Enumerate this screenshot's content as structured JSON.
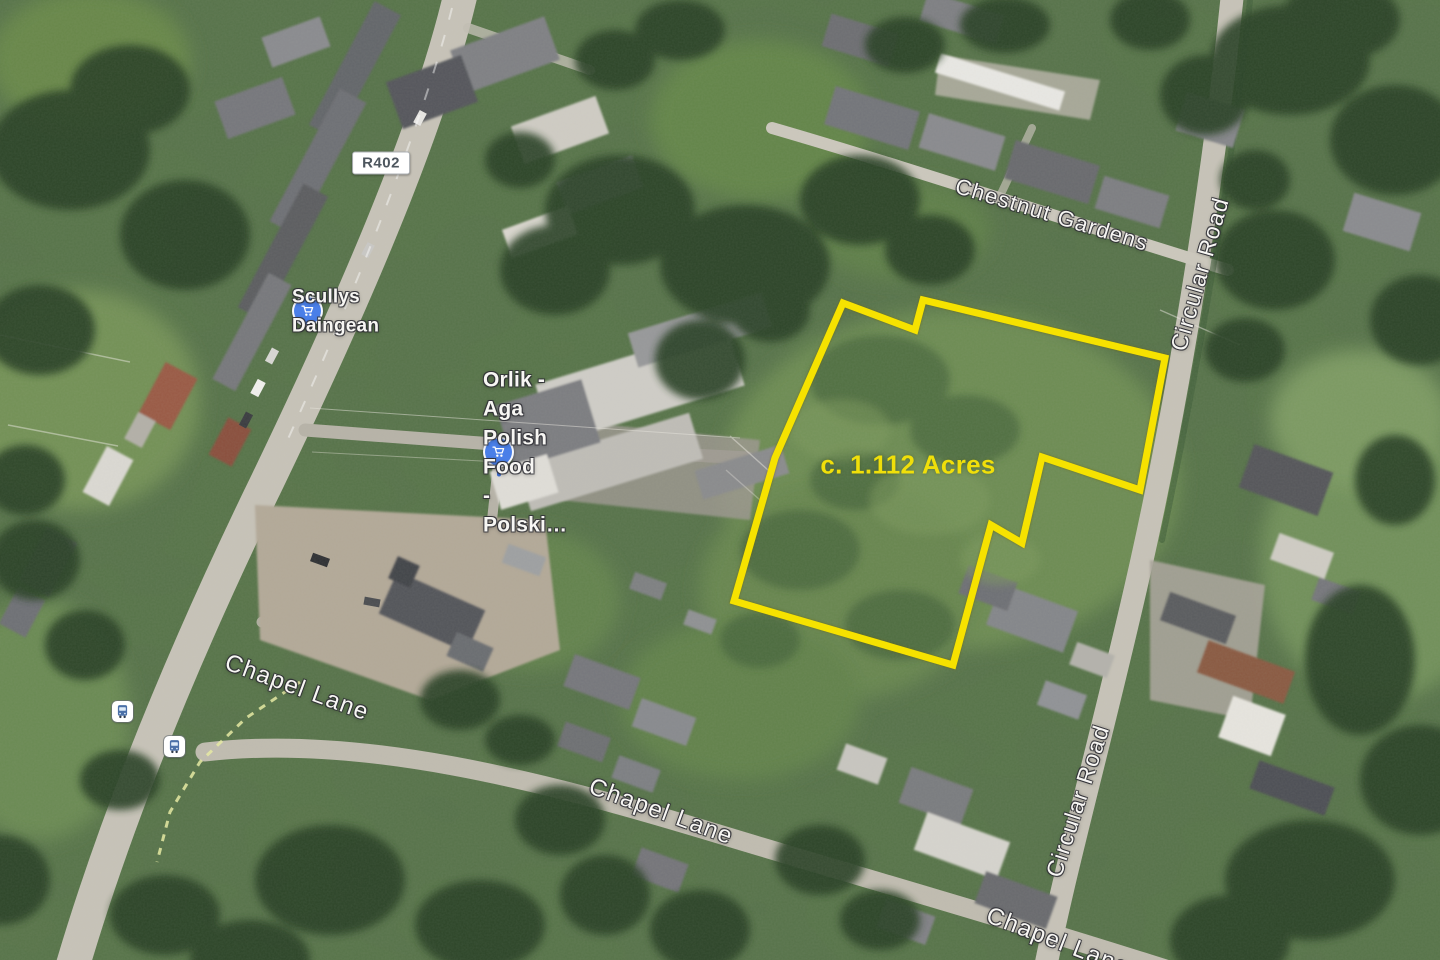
{
  "map": {
    "view_type": "satellite",
    "parcel": {
      "area_label": "c. 1.112 Acres",
      "outline_color": "#F6E203",
      "points": "843,303 915,330 923,300 1165,358 1140,490 1042,457 1022,543 991,525 953,665 734,601 775,458"
    },
    "route_badge": {
      "label": "R402"
    },
    "pois": [
      {
        "name": "Scullys Daingean",
        "icon": "shopping-cart"
      },
      {
        "name": "Orlik - Aga\nPolish Food\n- Polski…",
        "icon": "shopping-cart"
      }
    ],
    "road_labels": [
      {
        "text": "Chestnut Gardens"
      },
      {
        "text": "Circular Road"
      },
      {
        "text": "Circular Road"
      },
      {
        "text": "Chapel Lane"
      },
      {
        "text": "Chapel Lane"
      },
      {
        "text": "Chapel Lane"
      }
    ],
    "transit": [
      {
        "icon": "bus-stop"
      },
      {
        "icon": "bus-stop"
      }
    ],
    "colors": {
      "parcel_outline": "#F6E203",
      "area_text": "#F0DF0A",
      "poi_blue": "#4A7FE8",
      "road_fill": "#C7C3B8",
      "vegetation": "#587549"
    }
  }
}
